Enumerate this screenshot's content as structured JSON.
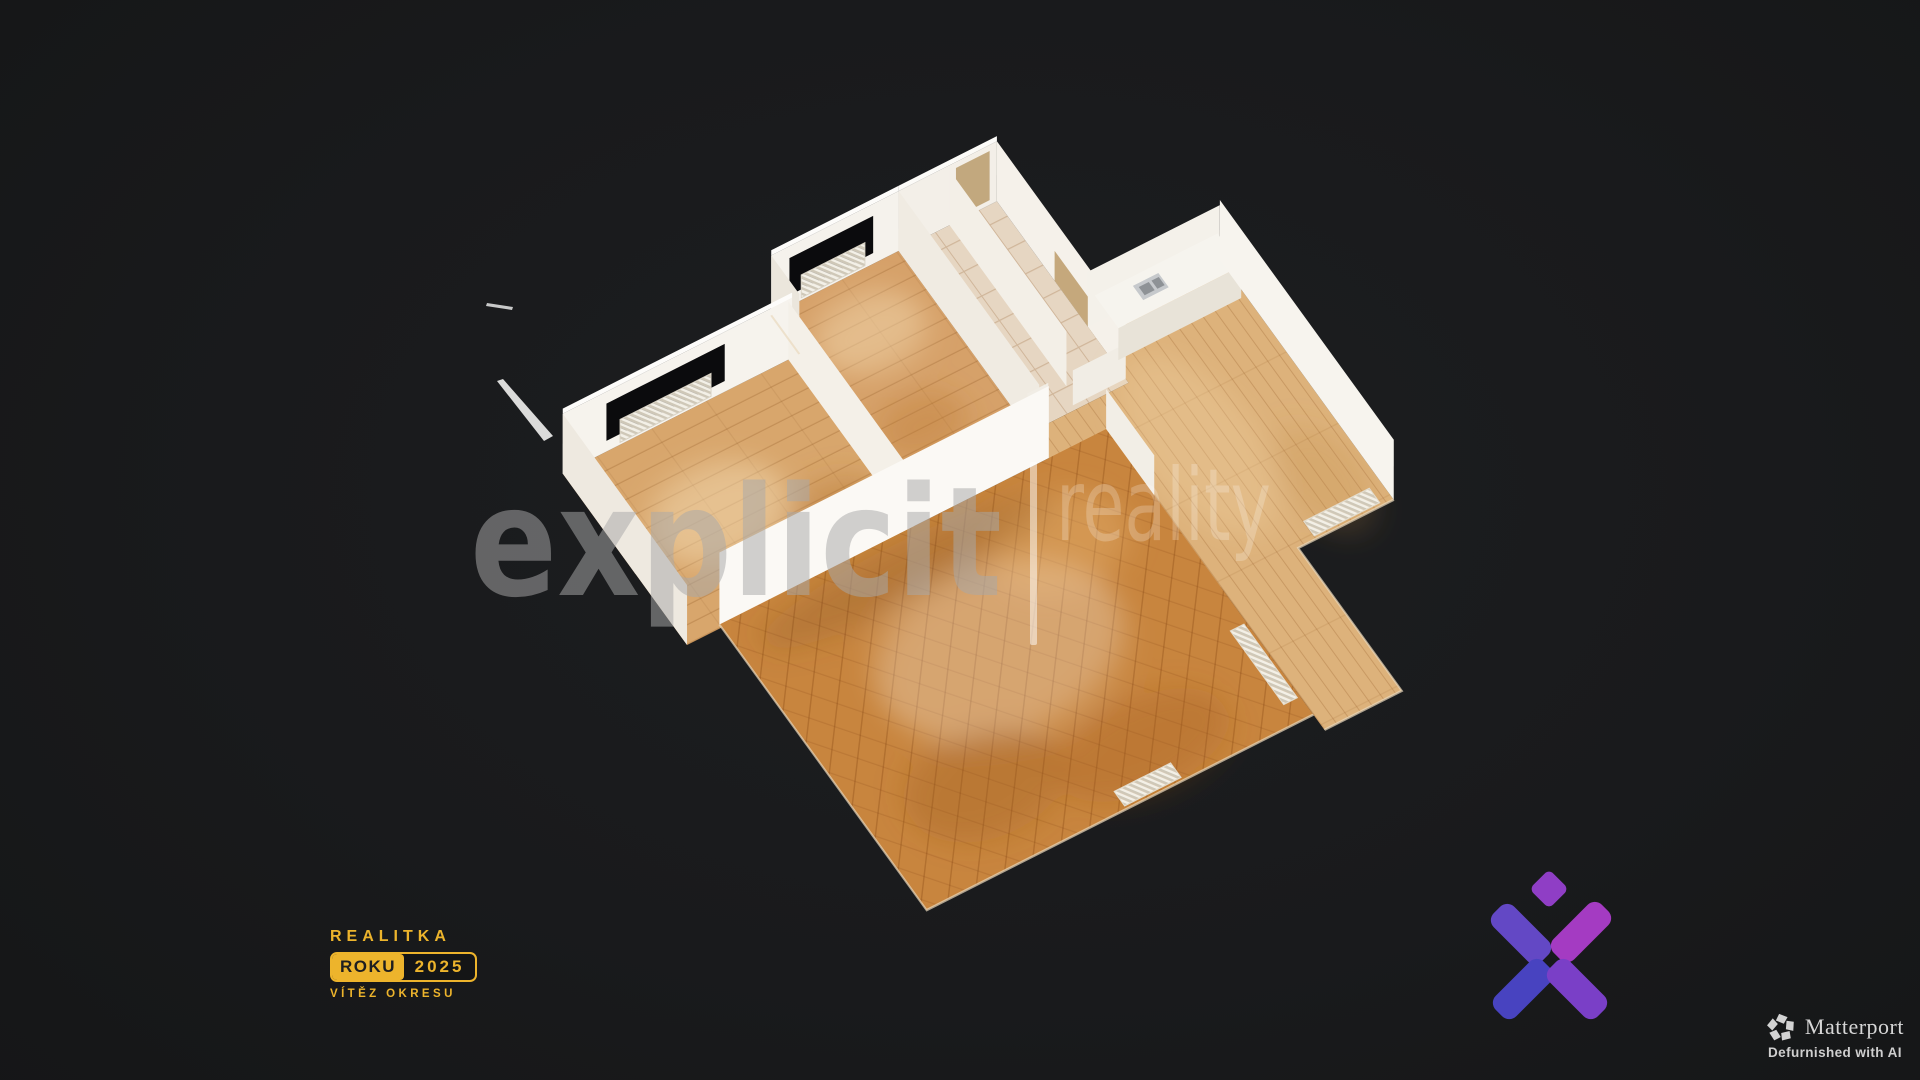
{
  "scene": {
    "description": "3D dollhouse cutaway view of an empty (defurnished) apartment on a dark background"
  },
  "watermark": {
    "brand": "explicit",
    "separator": "|",
    "suffix": "reality"
  },
  "award_badge": {
    "line1": "REALITKA",
    "box_left": "ROKU",
    "box_right": "2025",
    "line3": "VÍTĚZ OKRESU",
    "accent_color": "#edb42c"
  },
  "explicit_logo": {
    "icon": "x-mark-with-diamond",
    "colors": {
      "diamond": "#8f3ec5",
      "arm_top_left": "#6348c5",
      "arm_top_right": "#a43bc2",
      "arm_bottom_left": "#4843c0",
      "arm_bottom_right": "#7a3fc7"
    }
  },
  "matterport": {
    "brand": "Matterport",
    "tagline": "Defurnished with AI"
  },
  "floorplan": {
    "palette": {
      "background": "#191a1c",
      "walls": "#f5f2ec",
      "bedroom_parquet": "#d7a468",
      "living_room_parquet": "#c8853e",
      "corridor_kitchen_planks": "#ddb27b",
      "bathroom_tile": "#e6d6c2",
      "window_opening": "#0b0b0d"
    },
    "rooms": [
      {
        "name": "bedroom-1",
        "floor": "worn parquet",
        "features": [
          "window",
          "radiator"
        ]
      },
      {
        "name": "bedroom-2",
        "floor": "worn parquet",
        "features": [
          "window",
          "radiator"
        ]
      },
      {
        "name": "bathroom",
        "floor": "tile",
        "features": [
          "entry door"
        ]
      },
      {
        "name": "kitchen",
        "floor": "light wood planks",
        "features": [
          "counter",
          "sink",
          "radiator"
        ]
      },
      {
        "name": "hallway",
        "floor": "light wood planks",
        "features": []
      },
      {
        "name": "living-room",
        "floor": "herringbone parquet",
        "features": [
          "radiator",
          "radiator"
        ]
      }
    ]
  }
}
